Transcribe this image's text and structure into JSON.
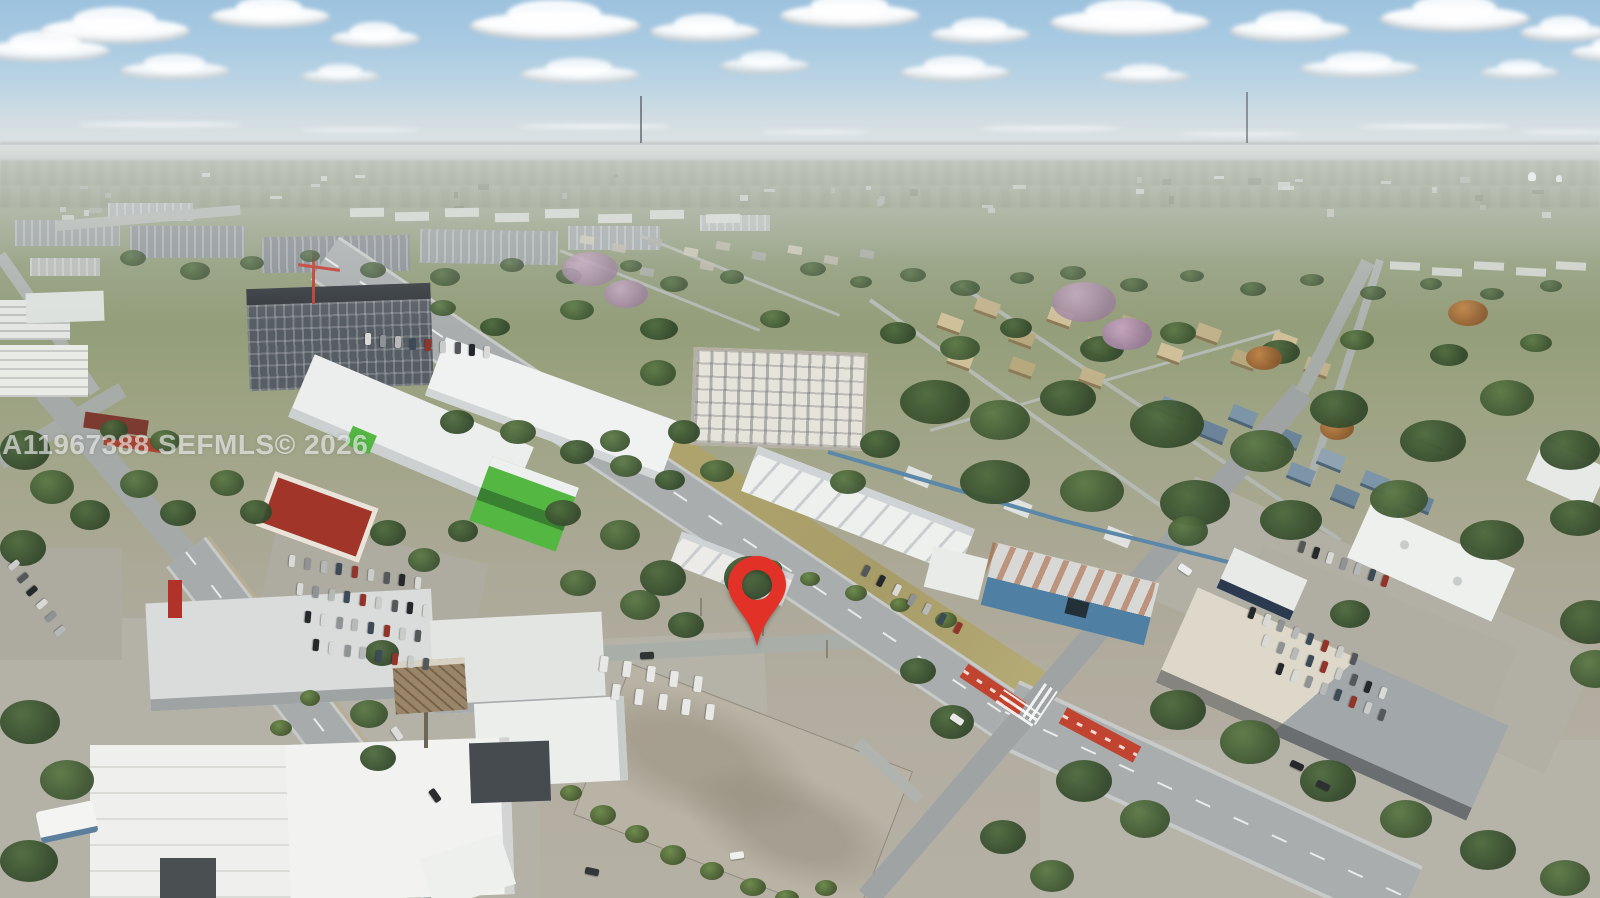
{
  "scene": {
    "type": "aerial-drone-photo",
    "description": "Aerial view of a commercial corridor and residential neighborhood with a red map pin marking a vacant lot"
  },
  "watermark": {
    "text": "A11967388 SEFMLS© 2026"
  },
  "marker": {
    "name": "map-pin",
    "color": "#e23127"
  },
  "palette": {
    "sky_top": "#9dc2de",
    "sky_horizon": "#dfe3e3",
    "cloud": "#ffffff",
    "vegetation_dark": "#33482b",
    "vegetation_mid": "#4f6b3e",
    "road": "#a9adae",
    "road_light": "#c7cac8",
    "concrete": "#b4b1a6",
    "storage_green": "#53b742",
    "warehouse_blue": "#4f7fa2",
    "transit_red": "#c0442f",
    "hotel_facade": "#575d64",
    "red_building": "#a23529",
    "white_roof": "#eef0ee"
  }
}
